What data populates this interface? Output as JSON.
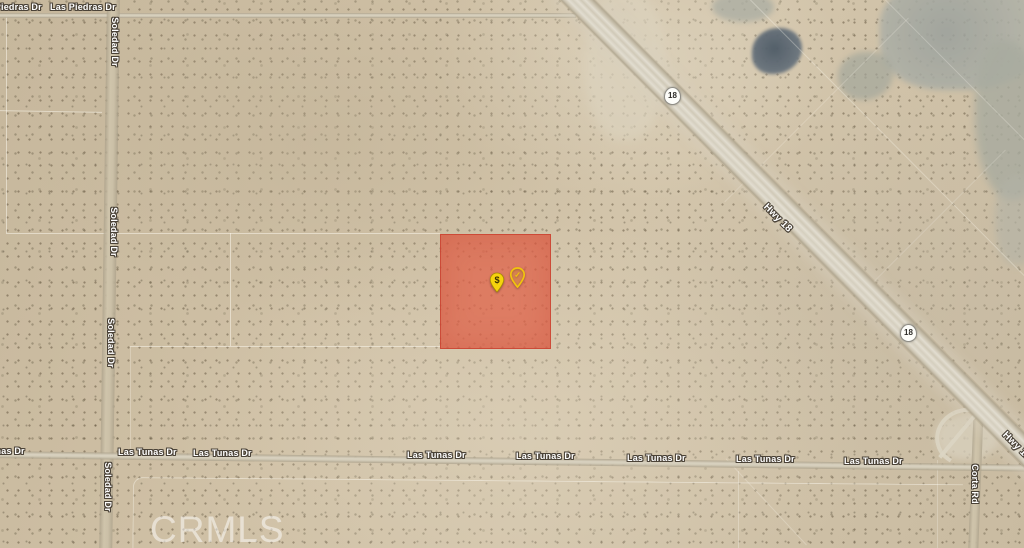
{
  "map": {
    "watermark": "CRMLS",
    "colors": {
      "parcel_highlight": "#e25840",
      "parcel_border": "#c83e2d",
      "pin_yellow": "#f2c90d",
      "terrain_base": "#ccbfa5"
    },
    "parcel_pins": {
      "price_glyph": "$",
      "check_glyph": "✓"
    },
    "roads": {
      "las_piedras": {
        "labels": [
          "Las Piedras Dr",
          "Las Piedras Dr"
        ]
      },
      "soledad": {
        "labels": [
          "Soledad Dr",
          "Soledad Dr",
          "Soledad Dr",
          "Soledad Dr"
        ]
      },
      "las_tunas": {
        "labels": [
          "Las Tunas Dr",
          "Las Tunas Dr",
          "Las Tunas Dr",
          "Las Tunas Dr",
          "Las Tunas Dr",
          "Las Tunas Dr",
          "Las Tunas Dr",
          "Las Tunas Dr"
        ]
      },
      "corta": {
        "labels": [
          "Corta Rd"
        ]
      },
      "hwy_18": {
        "labels": [
          "Hwy 18",
          "Hwy 18"
        ],
        "shields": [
          "18",
          "18"
        ]
      }
    }
  }
}
